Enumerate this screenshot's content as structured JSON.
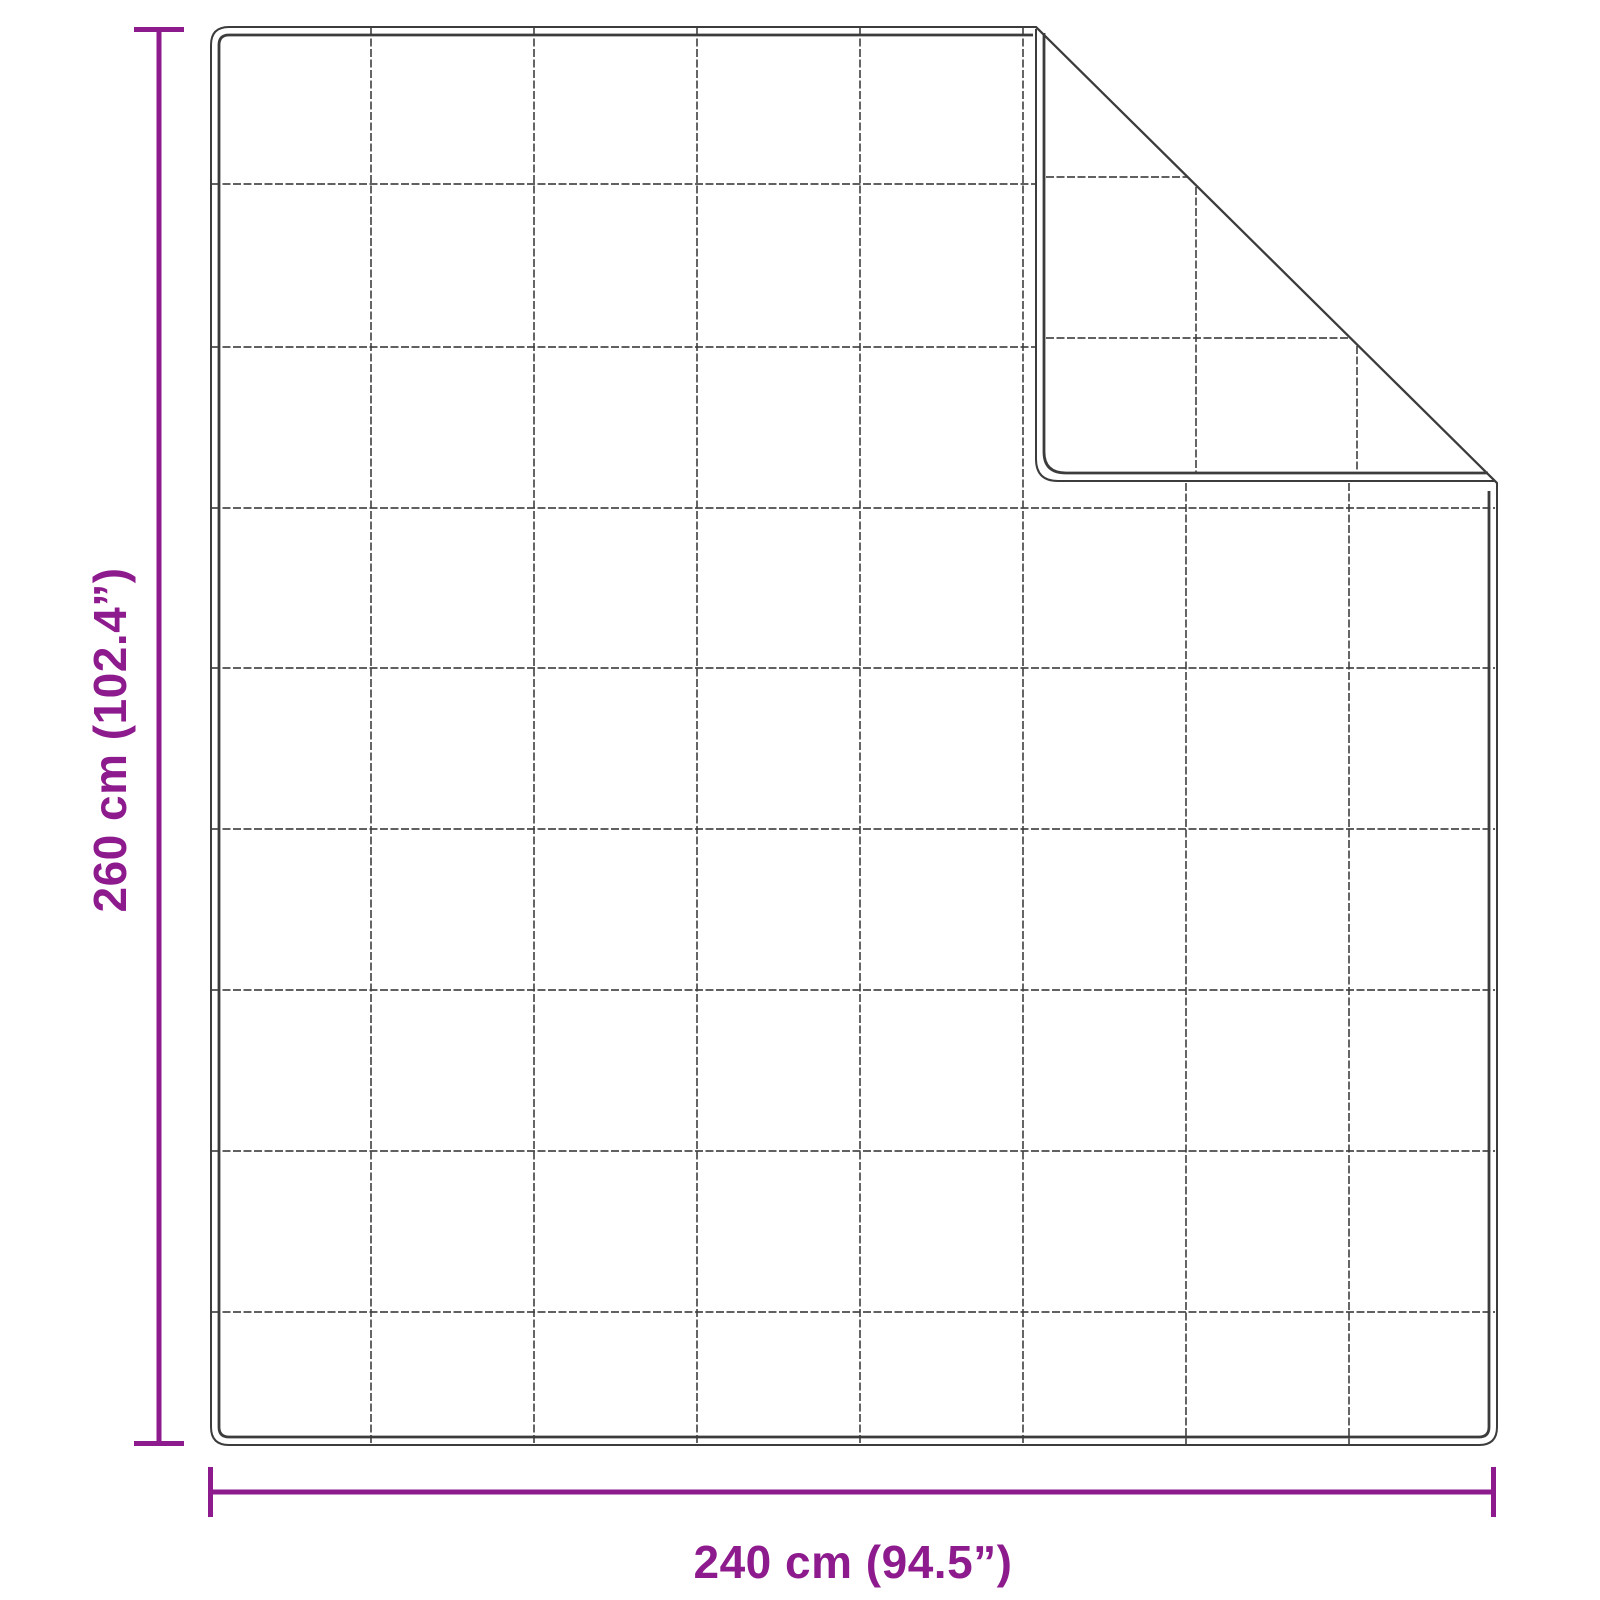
{
  "diagram": {
    "subject": "quilted-blanket-top-view-with-folded-corner",
    "height_label": "260 cm (102.4”)",
    "width_label": "240 cm (94.5”)",
    "grid": {
      "columns": 8,
      "rows": 9
    },
    "colors": {
      "dimension_accent": "#8d1b8d",
      "outline": "#3c3c3c",
      "background": "#ffffff"
    }
  }
}
